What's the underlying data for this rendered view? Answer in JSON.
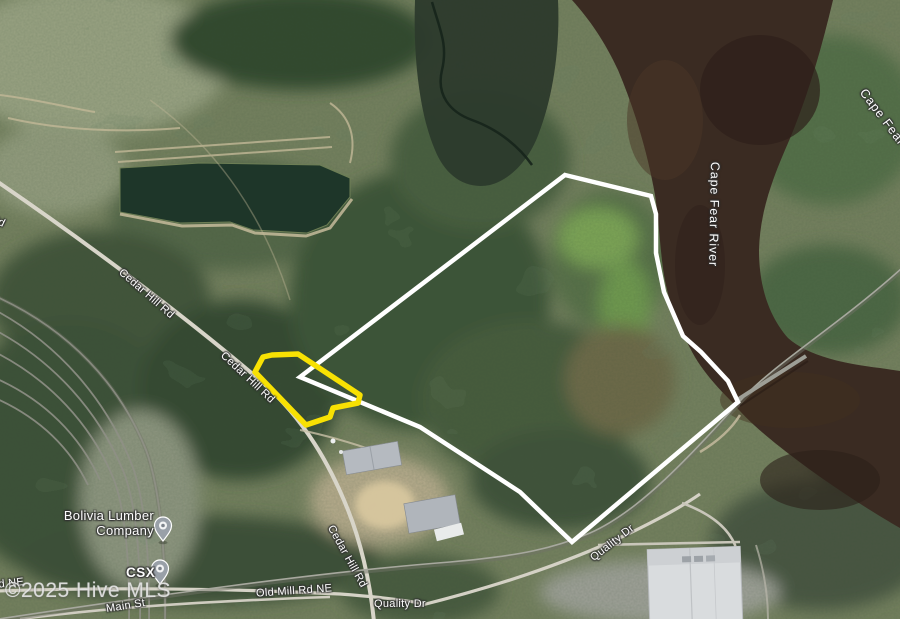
{
  "map": {
    "type": "satellite-view",
    "watermark": "©2025 Hive MLS",
    "labels": {
      "cape_fear_river": "Cape Fear River",
      "cedar_hill_rd": "Cedar Hill Rd",
      "old_mill_rd_ne": "Old Mill Rd NE",
      "quality_dr": "Quality Dr",
      "main_st": "Main St",
      "csx": "CSX",
      "bolivia_lumber_line1": "Bolivia Lumber",
      "bolivia_lumber_line2": "Company"
    },
    "markers": {
      "bolivia_lumber_pin": "place-pin",
      "csx_pin": "place-pin"
    },
    "colors": {
      "boundary_white": "#ffffff",
      "boundary_yellow": "#f8e103",
      "river_water": "#3a2b22"
    }
  }
}
